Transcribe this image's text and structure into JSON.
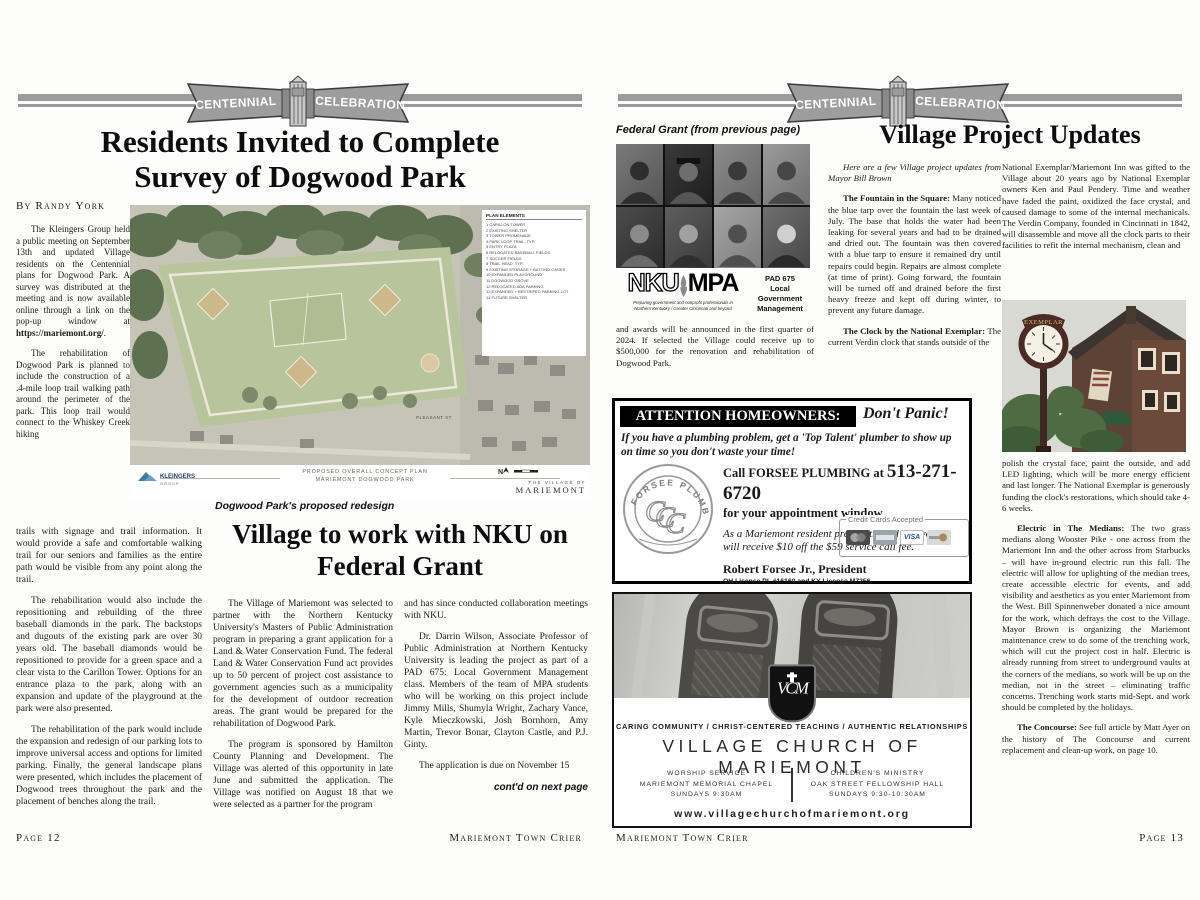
{
  "banner": {
    "left": "CENTENNIAL",
    "right": "CELEBRATION"
  },
  "left_page": {
    "headline": "Residents Invited to Complete Survey of Dogwood Park",
    "byline": "By Randy York",
    "article1": {
      "p1a": "The Kleingers Group held a public meeting on September 13th and updated Village residents on the Centennial plans for Dogwood Park. A survey was distributed at the meeting and is now available online through a link on the pop-up window at ",
      "p1_link": "https://mariemont.org/",
      "p1b": ".",
      "p2a": "The rehabilitation of Dogwood Park is planned to include the construction of a .4-mile loop trail walking path around the perimeter of the park. This loop trail would connect to the Whiskey Creek hiking",
      "p2b": "trails with signage and trail information. It would provide a safe and comfortable walking trail for our seniors and families as the entire path would be visible from any point along the trail.",
      "p3": "The rehabilitation would also include the repositioning and rebuilding of the three baseball diamonds in the park. The backstops and dugouts of the existing park are over 30 years old. The baseball diamonds would be repositioned to provide for a green space and a clear vista to the Carillon Tower. Options for an entrance plaza to the park, along with an expansion and update of the playground at the park were also presented.",
      "p4": "The rehabilitation of the park would include the expansion and redesign of our parking lots to improve universal access and options for limited parking. Finally, the general landscape plans were presented, which includes the placement of Dogwood trees throughout the park and the placement of benches along the trail."
    },
    "map": {
      "legend_title": "PLAN ELEMENTS",
      "legend_items": [
        "1  CARILLON TOWER",
        "2  EXISTING SHELTER",
        "3  TOWER PROMENADE",
        "4  PARK LOOP TRAIL, TYP.",
        "5  ENTRY PLAZA",
        "6  RELOCATED BASEBALL FIELDS",
        "7  SOCCER FIELDS",
        "8  TRAIL HEAD, TYP.",
        "9  EXISTING STORAGE + BATTING CAGES",
        "10  EXPANDED PLAYGROUND",
        "11  DOGWOOD GROVE",
        "12  RELOCATED ADA PARKING",
        "13  EXPANDED + RESTRIPED PARKING LOT",
        "14  FUTURE SHELTER"
      ],
      "street": "PLEASANT ST",
      "firm": "KLEINGERS",
      "firm2": "GROUP",
      "plan_line1": "PROPOSED OVERALL CONCEPT PLAN",
      "plan_line2": "MARIEMONT DOGWOOD PARK",
      "village_line1": "THE VILLAGE OF",
      "village_line2": "MARIEMONT",
      "north": "N",
      "caption": "Dogwood Park's proposed redesign"
    },
    "article2": {
      "headline": "Village to work with NKU on Federal Grant",
      "a1": "The Village of Mariemont was selected to partner with the Northern Kentucky University's Masters of Public Administration program in preparing a grant application for a Land & Water Conservation Fund. The federal Land & Water Conservation Fund act provides up to 50 percent of project cost assistance to government agencies such as a municipality for the development of outdoor recreation areas. The grant would be prepared for the rehabilitation of Dogwood Park.",
      "a2": "The program is sponsored by Hamilton County Planning and Development. The Village was alerted of this opportunity in late June and submitted the application. The Village was notified on August 18 that we were selected as a partner for the program",
      "b1": "and has since conducted collaboration meetings with NKU.",
      "b2": "Dr. Darrin Wilson, Associate Professor of Public Administration at Northern Kentucky University is leading the project as part of a PAD 675: Local Government Management class. Members of the team of MPA students who will be working on this project include Jimmy Mills, Shumyla Wright, Zachary Vance, Kyle Mieczkowski, Josh Bornhorn, Amy Martin, Trevor Bonar, Clayton Castle, and P.J. Ginty.",
      "b3": "The application is due on November 15",
      "contd": "cont'd on next page"
    },
    "footer": {
      "page": "Page 12",
      "crier": "Mariemont Town Crier"
    }
  },
  "right_page": {
    "continued": {
      "slug": "Federal Grant (from previous page)",
      "nku": "NKU",
      "mpa": "MPA",
      "tagline1": "Preparing government and nonprofit professionals in",
      "tagline2": "Northern Kentucky / Greater Cincinnati and beyond",
      "pad_line1": "PAD 675",
      "pad_line2": "Local",
      "pad_line3": "Government",
      "pad_line4": "Management",
      "paragraph": "and awards will be announced in the first quarter of 2024. If selected the Village could receive up to $500,000 for the renovation and rehabilitation of Dogwood Park."
    },
    "updates": {
      "headline": "Village Project Updates",
      "intro": "Here are a few Village project updates from Mayor Bill Brown",
      "fountain_lead": "The Fountain in the Square:",
      "fountain_body": " Many noticed the blue tarp over the fountain the last week of July. The base that holds the water had been leaking for several years and had to be drained and dried out. The fountain was then covered with a blue tarp to ensure it remained dry until repairs could begin. Repairs are almost complete (at time of print). Going forward, the fountain will be turned off and drained before the first heavy freeze and kept off during winter, to prevent any future damage.",
      "clock_lead": "The Clock by the National Exemplar:",
      "clock_body1": " The current Verdin clock that stands outside of the",
      "clock_body2": "National Exemplar/Mariemont Inn was gifted to the Village about 20 years ago by National Exemplar owners Ken and Paul Pendery. Time and weather have faded the paint, oxidized the face crystal, and caused damage to some of the internal mechanicals. The Verdin Company, founded in Cincinnati in 1842, will disassemble and move all the clock parts to their facilities to refit the internal mechanism, clean and",
      "clock_body3": "polish the crystal face, paint the outside, and add LED lighting, which will be more energy efficient and last longer. The National Exemplar is generously funding the clock's restorations, which should take 4-6 weeks.",
      "electric_lead": "Electric in The Medians:",
      "electric_body": " The two grass medians along Wooster Pike - one across from the Mariemont Inn and the other across from Starbucks – will have in-ground electric run this fall. The electric will allow for uplighting of the median trees, create accessible electric for events, and add visibility and aesthetics as you enter Mariemont from the West. Bill Spinnenweber donated a nice amount for the work, which defrays the cost to the Village. Mayor Brown is organizing the Mariemont maintenance crew to do some of the trenching work, which will cut the project cost in half. Electric is already running from street to underground vaults at the corners of the medians, so work will be up on the median, not in the street – eliminating traffic concerns. Trenching work starts mid-Sept. and work should be completed by the holidays.",
      "concourse_lead": "The Concourse:",
      "concourse_body": " See full article by Matt Ayer on the history of The Concourse and current replacement and clean-up work, on page 10.",
      "exemplar_sign": "EXEMPLAR"
    },
    "plumbing": {
      "attention": "ATTENTION HOMEOWNERS:",
      "dont_panic": "Don't Panic!",
      "pitch": "If you have a plumbing problem,  get a 'Top Talent' plumber to show up on time so you don't waste your time!",
      "logo_text": "FORSEE PLUMBING",
      "call_pre": "Call FORSEE PLUMBING at ",
      "phone": "513-271-6720",
      "call_post": "for your appointment window.",
      "offer": "As a Mariemont resident present this ad and you will receive $10 off the $59 service call fee.",
      "president": "Robert Forsee Jr., President",
      "license": "OH License PL #16160 and KY License M7256",
      "cc_label": "Credit Cards Accepted",
      "visa": "VISA"
    },
    "church": {
      "monogram": "VCM",
      "values": "CARING COMMUNITY / CHRIST-CENTERED TEACHING / AUTHENTIC RELATIONSHIPS",
      "name": "VILLAGE CHURCH OF MARIEMONT",
      "left1": "WORSHIP SERVICE",
      "left2": "MARIEMONT MEMORIAL CHAPEL",
      "left3": "SUNDAYS 9:30AM",
      "right1": "CHILDREN'S MINISTRY",
      "right2": "OAK STREET FELLOWSHIP HALL",
      "right3": "SUNDAYS 9:30-10:30AM",
      "url": "www.villagechurchofmariemont.org"
    },
    "footer": {
      "crier": "Mariemont Town Crier",
      "page": "Page 13"
    }
  }
}
